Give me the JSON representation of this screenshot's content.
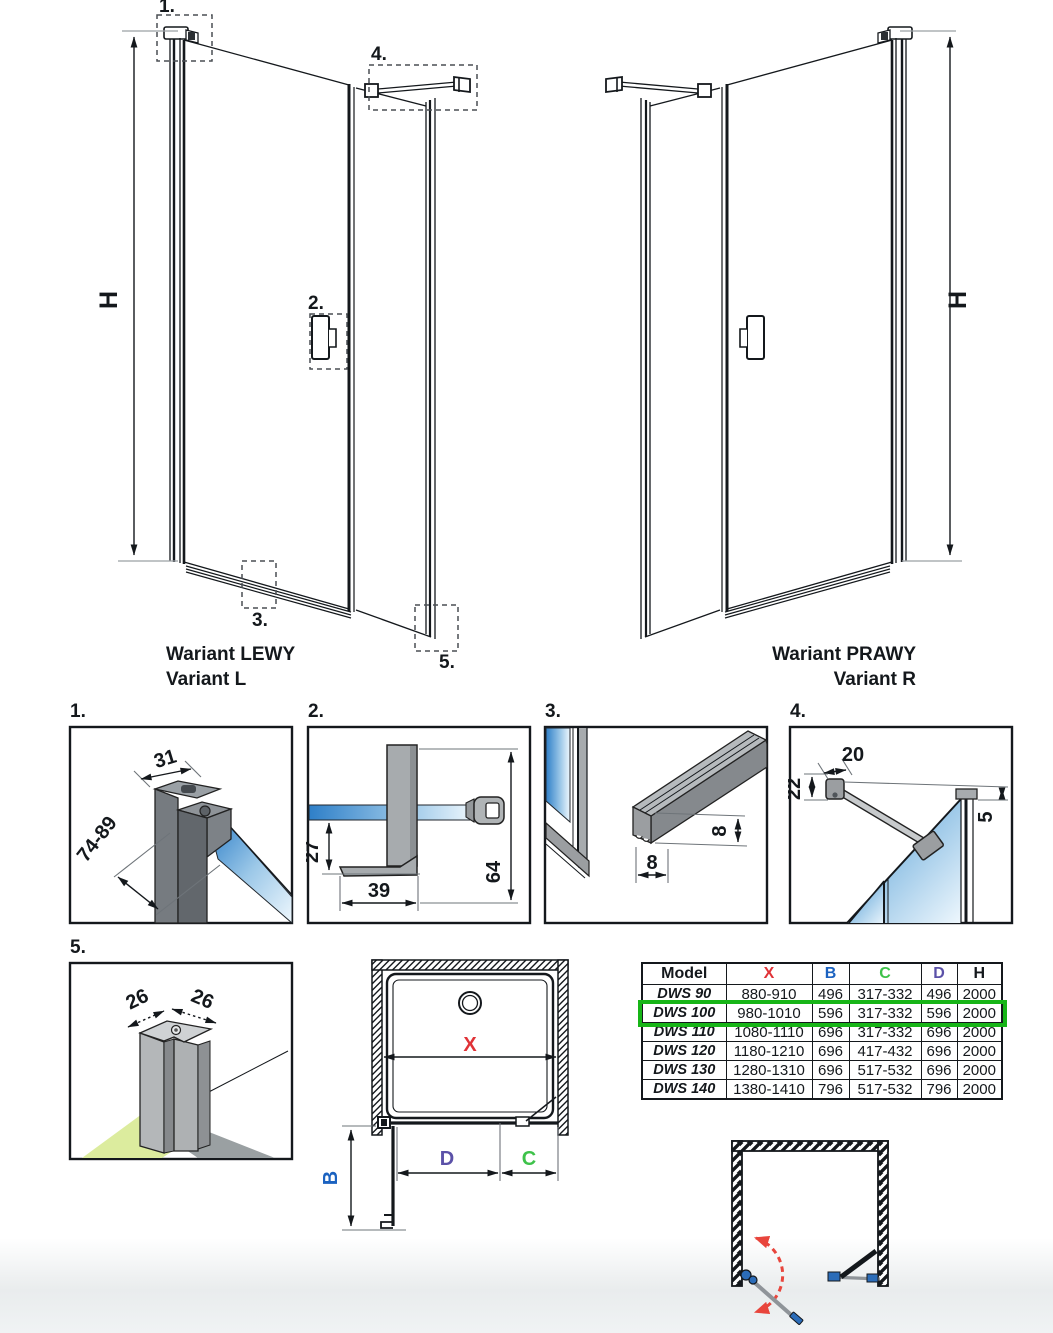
{
  "colors": {
    "line": "#14181c",
    "x": "#e03237",
    "b": "#1b62c0",
    "c": "#3ec24a",
    "d": "#5b51a8",
    "highlight": "#17b517",
    "glass_deep": "#2e7fc8",
    "glass_mid": "#9cc8e8",
    "glass_light": "#eef7fd",
    "floor_green": "#dcec9e",
    "swing_red": "#e8453c",
    "hinge_blue": "#2b6cb8"
  },
  "variants": {
    "left": {
      "caption1": "Wariant LEWY",
      "caption2": "Variant L",
      "height_label": "H",
      "callouts": {
        "c1": "1.",
        "c2": "2.",
        "c3": "3.",
        "c4": "4.",
        "c5": "5."
      }
    },
    "right": {
      "caption1": "Wariant PRAWY",
      "caption2": "Variant R",
      "height_label": "H"
    }
  },
  "details": {
    "d1": {
      "label": "1.",
      "dim_width": "31",
      "dim_range": "74-89"
    },
    "d2": {
      "label": "2.",
      "dim_glass": "27",
      "dim_foot": "39",
      "dim_total": "64"
    },
    "d3": {
      "label": "3.",
      "dim_h": "8",
      "dim_w": "8"
    },
    "d4": {
      "label": "4.",
      "dim_bar": "20",
      "dim_drop": "22",
      "dim_gap": "5"
    },
    "d5": {
      "label": "5.",
      "dim_left": "26",
      "dim_right": "26"
    }
  },
  "plan": {
    "x": "X",
    "b": "B",
    "c": "C",
    "d": "D"
  },
  "table": {
    "headers": {
      "model": "Model",
      "x": "X",
      "b": "B",
      "c": "C",
      "d": "D",
      "h": "H"
    },
    "rows": [
      {
        "model": "DWS 90",
        "x": "880-910",
        "b": "496",
        "c": "317-332",
        "d": "496",
        "h": "2000"
      },
      {
        "model": "DWS 100",
        "x": "980-1010",
        "b": "596",
        "c": "317-332",
        "d": "596",
        "h": "2000"
      },
      {
        "model": "DWS 110",
        "x": "1080-1110",
        "b": "696",
        "c": "317-332",
        "d": "696",
        "h": "2000"
      },
      {
        "model": "DWS 120",
        "x": "1180-1210",
        "b": "696",
        "c": "417-432",
        "d": "696",
        "h": "2000"
      },
      {
        "model": "DWS 130",
        "x": "1280-1310",
        "b": "696",
        "c": "517-532",
        "d": "696",
        "h": "2000"
      },
      {
        "model": "DWS 140",
        "x": "1380-1410",
        "b": "796",
        "c": "517-532",
        "d": "796",
        "h": "2000"
      }
    ],
    "highlighted_row": "DWS 100"
  }
}
